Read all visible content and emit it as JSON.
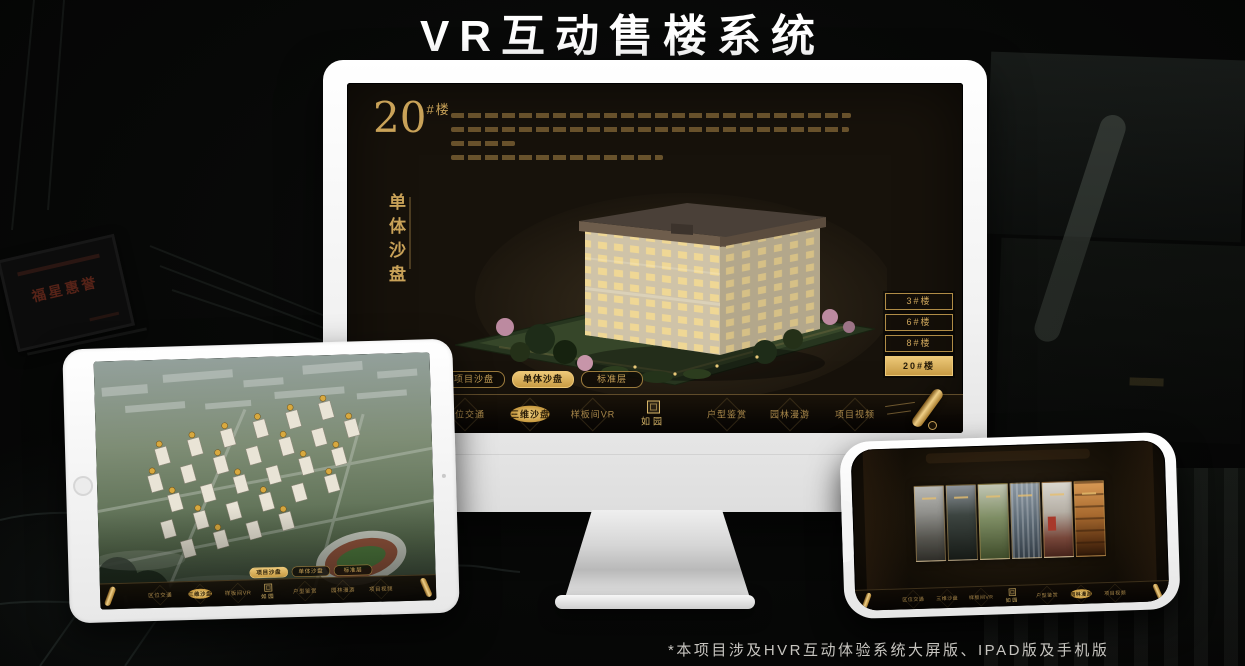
{
  "page": {
    "title": "VR互动售楼系统",
    "footnote": "*本项目涉及HVR互动体验系统大屏版、IPAD版及手机版"
  },
  "colors": {
    "gold": "#c9a05a",
    "gold_bright": "#e7c06c",
    "screen_dark": "#17120b",
    "footnote_gray": "#c6c4bf",
    "title_white": "#ffffff"
  },
  "background": {
    "plaque_text": "福星惠誉"
  },
  "monitor": {
    "unit": {
      "number": "20",
      "suffix": "#楼",
      "subtitle": "单体沙盘"
    },
    "floors": [
      {
        "label": "3#楼",
        "selected": false
      },
      {
        "label": "6#楼",
        "selected": false
      },
      {
        "label": "8#楼",
        "selected": false
      },
      {
        "label": "20#楼",
        "selected": true
      }
    ],
    "tabs": [
      {
        "label": "项目沙盘",
        "selected": false
      },
      {
        "label": "单体沙盘",
        "selected": true
      },
      {
        "label": "标准层",
        "selected": false
      }
    ],
    "menu_left": [
      "区位交通",
      "三维沙盘",
      "样板间VR"
    ],
    "menu_right": [
      "户型鉴赏",
      "园林漫游",
      "项目视频"
    ],
    "selected_menu": "三维沙盘",
    "logo": "如园"
  },
  "tablet": {
    "tabs": [
      {
        "label": "项目沙盘",
        "selected": true
      },
      {
        "label": "单体沙盘",
        "selected": false
      },
      {
        "label": "标准层",
        "selected": false
      }
    ],
    "menu_left": [
      "区位交通",
      "三维沙盘",
      "样板间VR"
    ],
    "menu_right": [
      "户型鉴赏",
      "园林漫游",
      "项目视频"
    ],
    "selected_menu": "三维沙盘",
    "logo": "如园"
  },
  "phone": {
    "menu_left": [
      "区位交通",
      "三维沙盘",
      "样板间VR"
    ],
    "menu_right": [
      "户型鉴赏",
      "园林漫游",
      "项目视频"
    ],
    "selected_menu": "园林漫游",
    "logo": "如园"
  }
}
